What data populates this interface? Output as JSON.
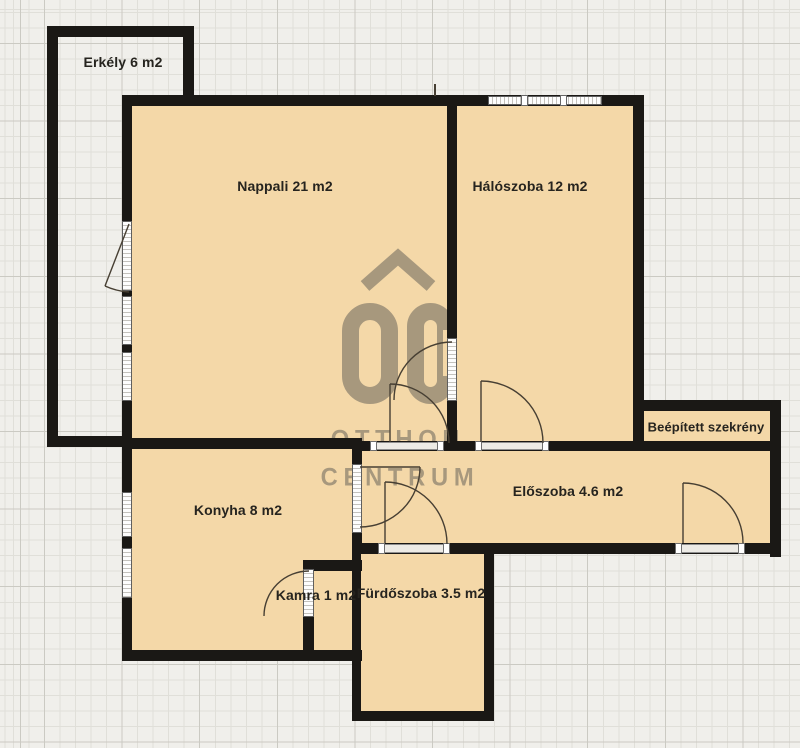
{
  "plan": {
    "title": "Apartment floor plan",
    "rooms": {
      "erkely": {
        "name": "Erkély",
        "area": "6 m2",
        "label": "Erkély 6 m2"
      },
      "nappali": {
        "name": "Nappali",
        "area": "21 m2",
        "label": "Nappali 21 m2"
      },
      "haloszoba": {
        "name": "Hálószoba",
        "area": "12 m2",
        "label": "Hálószoba 12 m2"
      },
      "beepitett_szekreny": {
        "name": "Beépített szekrény",
        "label": "Beépített szekrény"
      },
      "eloszoba": {
        "name": "Előszoba",
        "area": "4.6 m2",
        "label": "Előszoba 4.6 m2"
      },
      "konyha": {
        "name": "Konyha",
        "area": "8 m2",
        "label": "Konyha 8 m2"
      },
      "kamra": {
        "name": "Kamra",
        "area": "1 m2",
        "label": "Kamra 1 m2"
      },
      "furdoszoba": {
        "name": "Fürdőszoba",
        "area": "3.5 m2",
        "label": "Fürdőszoba 3.5 m2"
      }
    },
    "watermark": {
      "logo": "OC",
      "line1": "OTTHON",
      "line2": "CENTRUM"
    },
    "colors": {
      "floor": "#f4d8a8",
      "wall": "#1a1815",
      "background": "#f0efeb",
      "grid_minor": "#e0dfd9",
      "grid_major": "#cbcac3",
      "watermark": "#5c5954",
      "label": "#26241f"
    }
  }
}
